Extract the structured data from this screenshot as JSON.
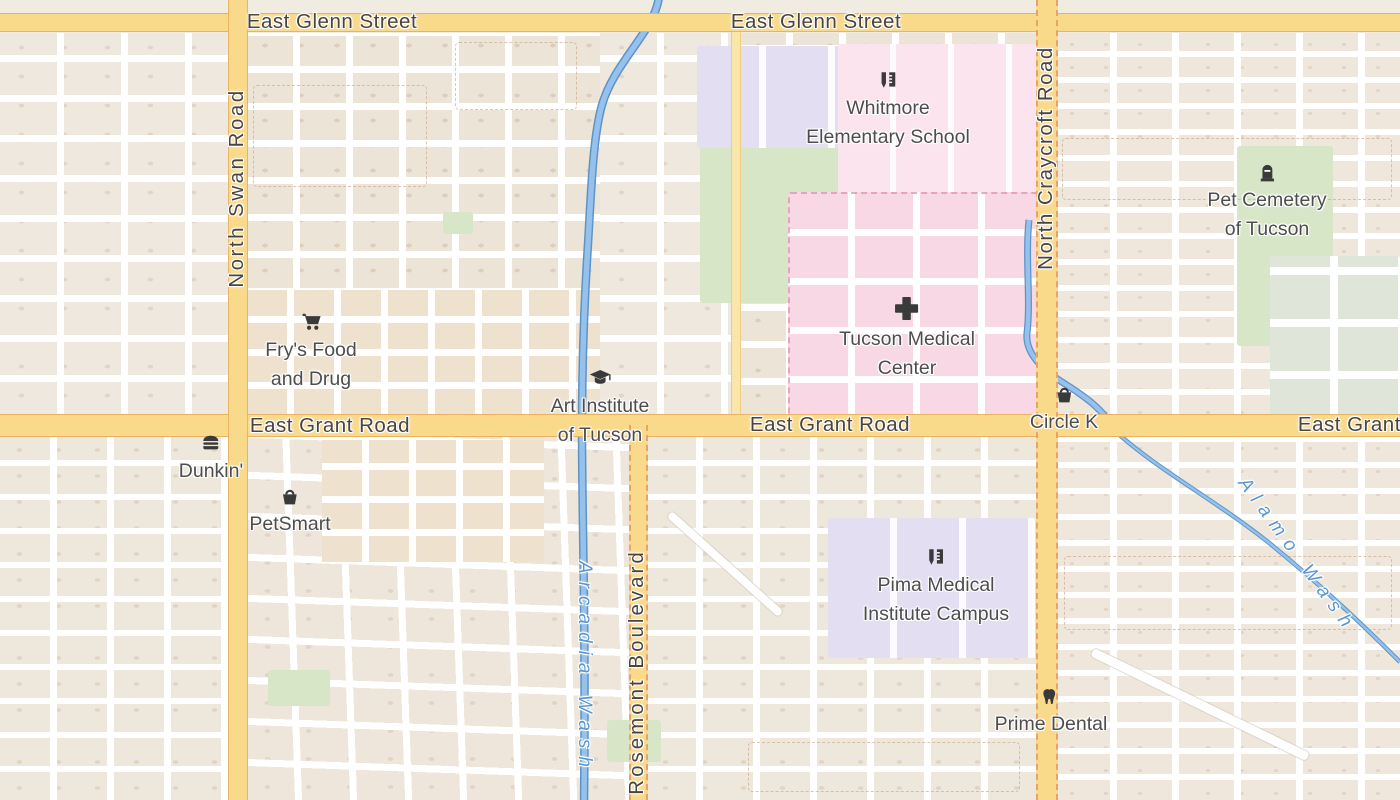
{
  "map": {
    "region": "Tucson, Arizona street map",
    "road_labels": {
      "east_glenn_street": "East Glenn Street",
      "east_grant_road": "East Grant Road",
      "north_swan_road": "North Swan Road",
      "north_craycroft_road": "North Craycroft Road",
      "rosemont_boulevard": "Rosemont Boulevard"
    },
    "waterway_labels": {
      "arcadia_wash": "Arcadia Wash",
      "alamo_wash": "Alamo Wash"
    },
    "pois": [
      {
        "name": "Whitmore Elementary School",
        "lines": [
          "Whitmore",
          "Elementary School"
        ],
        "icon": "school-icon"
      },
      {
        "name": "Pet Cemetery of Tucson",
        "lines": [
          "Pet Cemetery",
          "of Tucson"
        ],
        "icon": "grave-icon"
      },
      {
        "name": "Fry's Food and Drug",
        "lines": [
          "Fry's Food",
          "and Drug"
        ],
        "icon": "shopping-cart-icon"
      },
      {
        "name": "Art Institute of Tucson",
        "lines": [
          "Art Institute",
          "of Tucson"
        ],
        "icon": "graduation-cap-icon"
      },
      {
        "name": "Tucson Medical Center",
        "lines": [
          "Tucson Medical",
          "Center"
        ],
        "icon": "hospital-cross-icon"
      },
      {
        "name": "Circle K",
        "lines": [
          "Circle K"
        ],
        "icon": "basket-icon"
      },
      {
        "name": "Dunkin'",
        "lines": [
          "Dunkin'"
        ],
        "icon": "fast-food-icon"
      },
      {
        "name": "PetSmart",
        "lines": [
          "PetSmart"
        ],
        "icon": "basket-icon"
      },
      {
        "name": "Pima Medical Institute Campus",
        "lines": [
          "Pima Medical",
          "Institute Campus"
        ],
        "icon": "school-icon"
      },
      {
        "name": "Prime Dental",
        "lines": [
          "Prime Dental"
        ],
        "icon": "tooth-icon"
      }
    ],
    "palette": {
      "land": "#f1ece2",
      "residential": "#ece3d8",
      "major_road": "#f9d98a",
      "minor_road": "#ffffff",
      "water": "#8cbbe8",
      "water_label": "#5b97cf",
      "hospital_area": "#f8d8e4",
      "school_area": "#e3def1",
      "grass": "#d8e6c8",
      "road_label": "#4a443d",
      "poi_label": "#4d4d4d",
      "poi_icon": "#3a3a3a"
    }
  }
}
